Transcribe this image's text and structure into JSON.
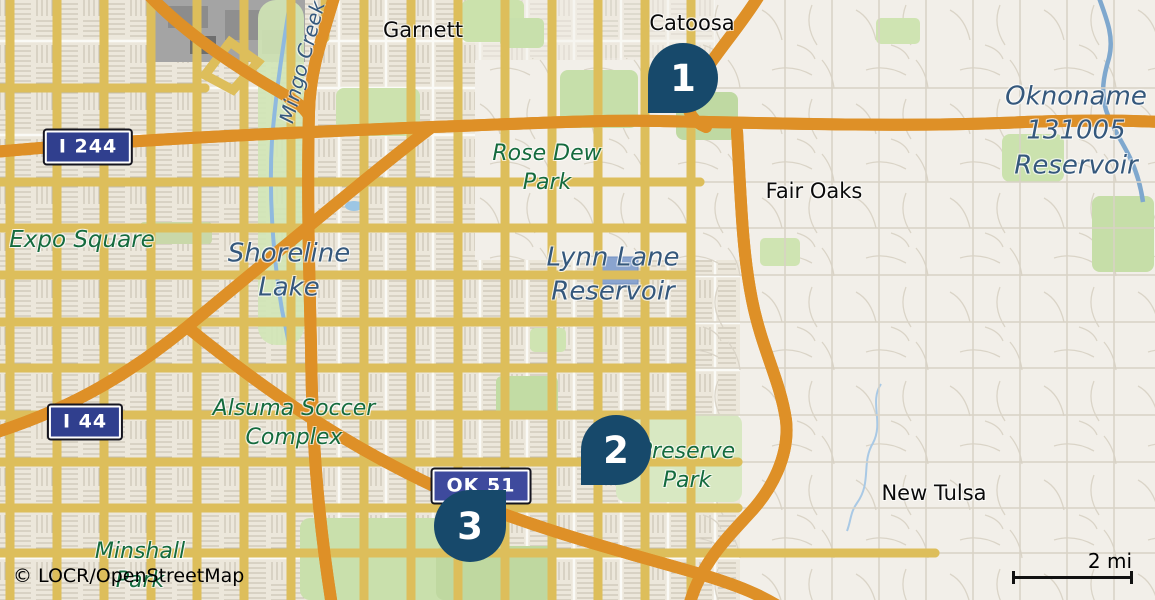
{
  "map": {
    "attribution": "© LOCR/OpenStreetMap",
    "scale": {
      "label": "2 mi"
    },
    "markers": [
      {
        "number": "1"
      },
      {
        "number": "2"
      },
      {
        "number": "3"
      }
    ],
    "shields": [
      {
        "label": "I 244"
      },
      {
        "label": "I 44"
      },
      {
        "label": "OK 51"
      }
    ],
    "labels": {
      "garnett": "Garnett",
      "catoosa": "Catoosa",
      "fair_oaks": "Fair Oaks",
      "new_tulsa": "New Tulsa",
      "expo_square": "Expo Square",
      "mingo_creek": "Mingo Creek",
      "rose_dew": [
        "Rose Dew",
        "Park"
      ],
      "alsuma": [
        "Alsuma Soccer",
        "Complex"
      ],
      "preserve": [
        "Preserve",
        "Park"
      ],
      "minshall": [
        "Minshall",
        "Park"
      ],
      "shoreline": [
        "Shoreline",
        "Lake"
      ],
      "lynn_lane": [
        "Lynn Lane",
        "Reservoir"
      ],
      "oknoname": [
        "Oknoname",
        "131005",
        "Reservoir"
      ]
    },
    "colors": {
      "bg": "#F2EFE9",
      "road_fill": "#FCE38D",
      "road_casing": "#DDBE5B",
      "motorway_fill": "#F4A73B",
      "motorway_casing": "#DE9027",
      "water": "#8FB9DF",
      "reservoir": "#8AA4CF",
      "marker": "#17496B",
      "shield_interstate": "#303F8E",
      "shield_state": "#3E4A9D",
      "label_park": "#156B3E",
      "label_water": "#35587C",
      "label_place": "#0A0A0A"
    }
  }
}
